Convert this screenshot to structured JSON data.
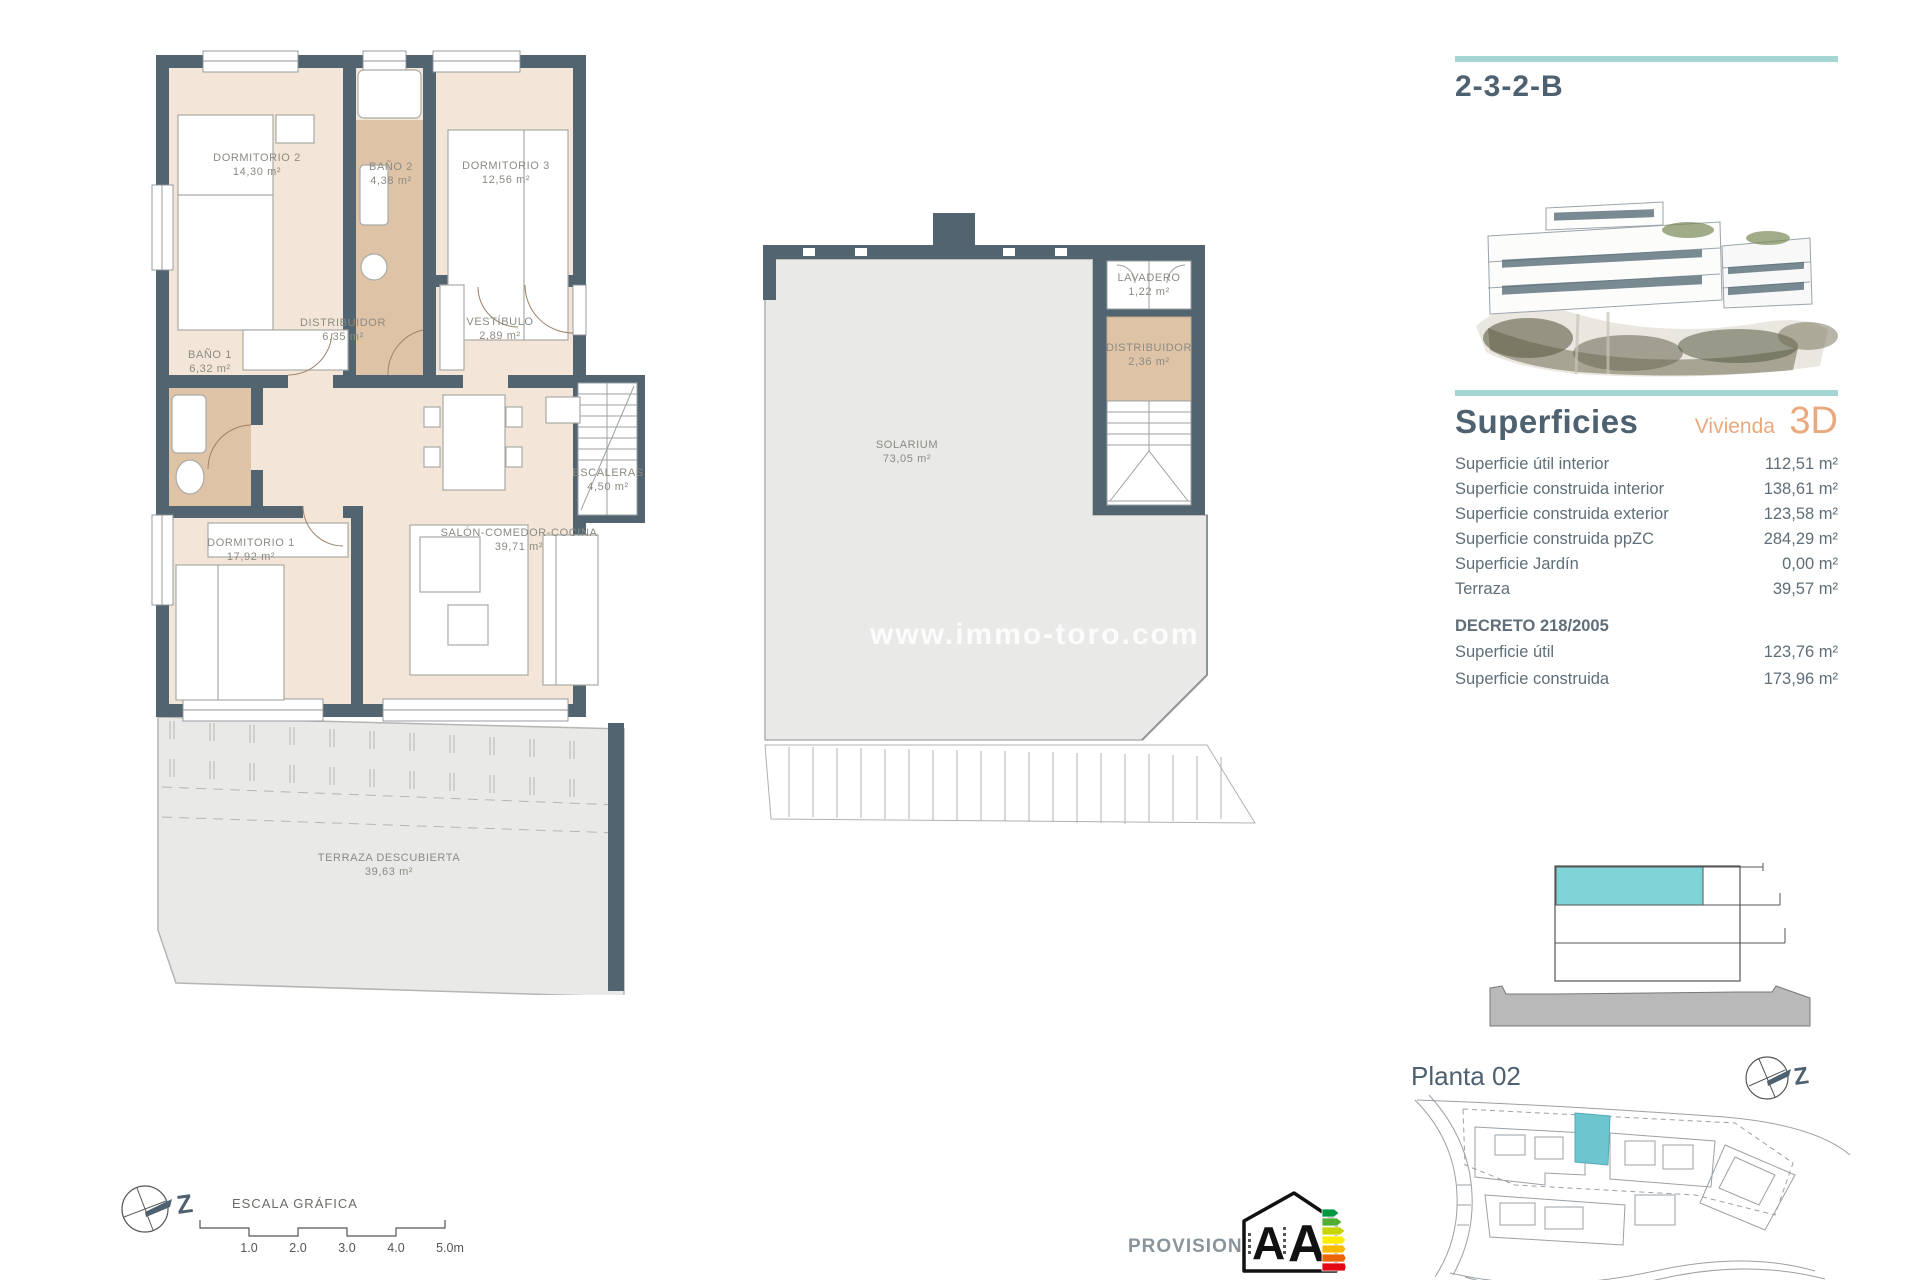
{
  "unit": {
    "code": "2-3-2-B"
  },
  "plan1": {
    "rooms": [
      {
        "name": "DORMITORIO 2",
        "area": "14,30 m²"
      },
      {
        "name": "BAÑO 2",
        "area": "4,38 m²"
      },
      {
        "name": "DORMITORIO 3",
        "area": "12,56 m²"
      },
      {
        "name": "BAÑO 1",
        "area": "6,32 m²"
      },
      {
        "name": "DISTRIBUIDOR",
        "area": "6,35 m²"
      },
      {
        "name": "VESTÍBULO",
        "area": "2,89 m²"
      },
      {
        "name": "ESCALERAS",
        "area": "4,50 m²"
      },
      {
        "name": "DORMITORIO 1",
        "area": "17,92 m²"
      },
      {
        "name": "SALÓN-COMEDOR-COCINA",
        "area": "39,71 m²"
      },
      {
        "name": "TERRAZA DESCUBIERTA",
        "area": "39,63 m²"
      }
    ]
  },
  "plan2": {
    "rooms": [
      {
        "name": "LAVADERO",
        "area": "1,22 m²"
      },
      {
        "name": "DISTRIBUIDOR",
        "area": "2,36 m²"
      },
      {
        "name": "SOLARIUM",
        "area": "73,05 m²"
      }
    ],
    "watermark": "www.immo-toro.com"
  },
  "superficies": {
    "title": "Superficies",
    "vivienda_label": "Vivienda",
    "vivienda_value": "3D",
    "rows": [
      {
        "label": "Superficie útil interior",
        "value": "112,51 m²"
      },
      {
        "label": "Superficie construida interior",
        "value": "138,61 m²"
      },
      {
        "label": "Superficie construida exterior",
        "value": "123,58 m²"
      },
      {
        "label": "Superficie construida ppZC",
        "value": "284,29 m²"
      },
      {
        "label": "Superficie Jardín",
        "value": "0,00 m²"
      },
      {
        "label": "Terraza",
        "value": "39,57 m²"
      }
    ],
    "decreto_title": "DECRETO 218/2005",
    "decreto_rows": [
      {
        "label": "Superficie útil",
        "value": "123,76 m²"
      },
      {
        "label": "Superficie construida",
        "value": "173,96 m²"
      }
    ]
  },
  "site": {
    "title": "Planta 02"
  },
  "scale": {
    "title": "ESCALA GRÁFICA",
    "ticks": [
      "1.0",
      "2.0",
      "3.0",
      "4.0",
      "5.0m"
    ]
  },
  "compass": {
    "label": "Z"
  },
  "footer": {
    "provisional": "PROVISIONAL"
  },
  "energy": {
    "letters": "A A"
  },
  "colors": {
    "teal": "#a5d6d3",
    "slate": "#4e6170",
    "orange": "#e9a97e",
    "wall": "#52646f",
    "room_fill": "#f3e6d8",
    "bath_fill": "#dfc3a7",
    "terrace_fill": "#e9e9e7",
    "highlight": "#6cc5cf"
  }
}
